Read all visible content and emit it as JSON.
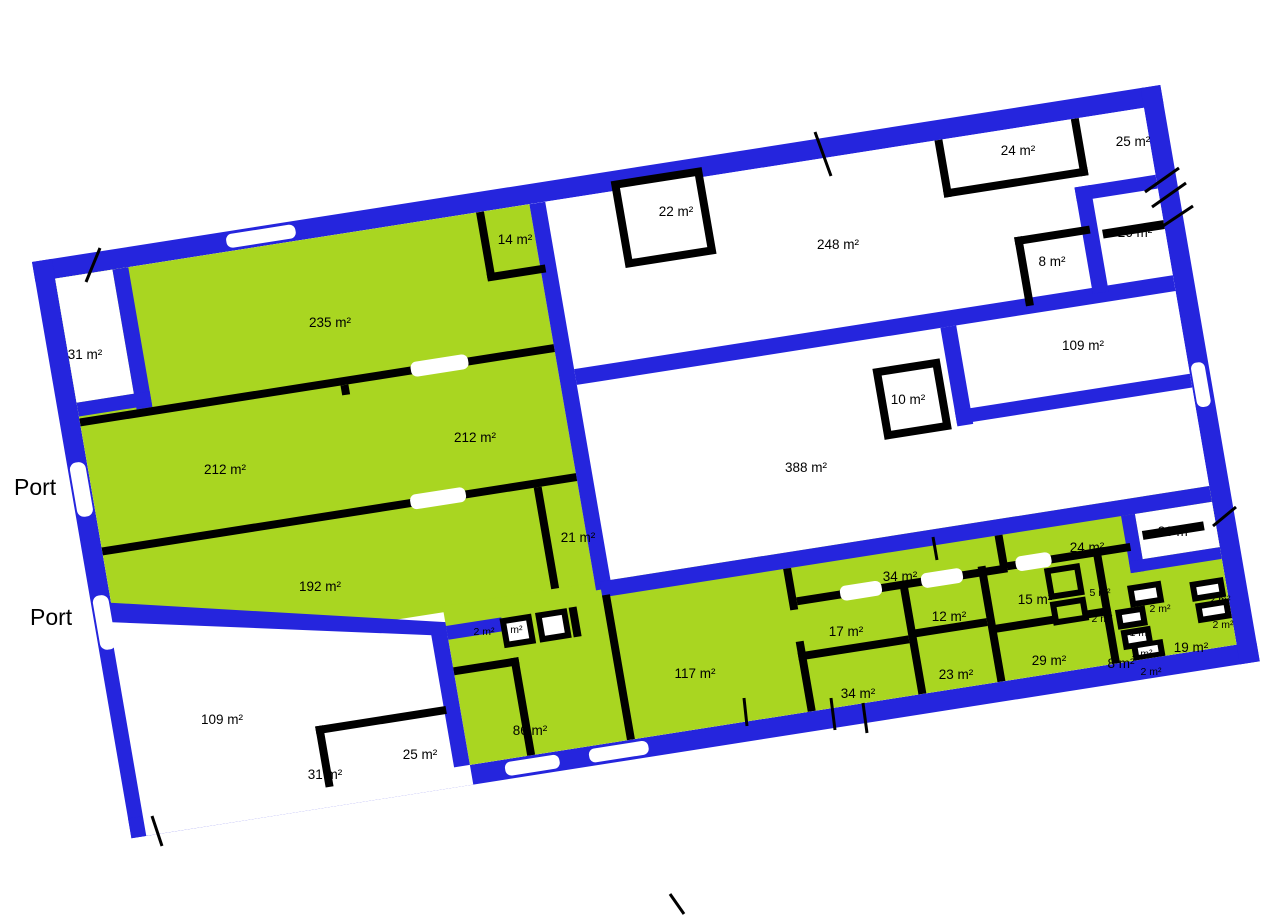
{
  "plan": {
    "colors": {
      "wall_exterior": "#2525dd",
      "wall_interior": "#000000",
      "room_highlight": "#a9d621",
      "room_plain": "#ffffff",
      "label_color": "#000000",
      "background": "#ffffff"
    },
    "ports": [
      {
        "label": "Port",
        "x": 14,
        "y": 495
      },
      {
        "label": "Port",
        "x": 30,
        "y": 625
      }
    ],
    "rooms": [
      {
        "id": "31-top-left",
        "label": "31 m²",
        "highlighted": false,
        "x": 85,
        "y": 359,
        "small": false
      },
      {
        "id": "235",
        "label": "235 m²",
        "highlighted": true,
        "x": 330,
        "y": 327,
        "small": false
      },
      {
        "id": "14",
        "label": "14 m²",
        "highlighted": true,
        "x": 515,
        "y": 244,
        "small": false
      },
      {
        "id": "212-right",
        "label": "212 m²",
        "highlighted": true,
        "x": 475,
        "y": 442,
        "small": false
      },
      {
        "id": "212-left",
        "label": "212 m²",
        "highlighted": true,
        "x": 225,
        "y": 474,
        "small": false
      },
      {
        "id": "192",
        "label": "192 m²",
        "highlighted": true,
        "x": 320,
        "y": 591,
        "small": false
      },
      {
        "id": "21",
        "label": "21 m²",
        "highlighted": true,
        "x": 578,
        "y": 542,
        "small": false
      },
      {
        "id": "2-box-a",
        "label": "2 m²",
        "highlighted": false,
        "x": 484,
        "y": 635,
        "small": true
      },
      {
        "id": "2-box-b",
        "label": "2 m²",
        "highlighted": false,
        "x": 512,
        "y": 633,
        "small": true
      },
      {
        "id": "22",
        "label": "22 m²",
        "highlighted": false,
        "x": 676,
        "y": 216,
        "small": false
      },
      {
        "id": "248",
        "label": "248 m²",
        "highlighted": false,
        "x": 838,
        "y": 249,
        "small": false
      },
      {
        "id": "24-top",
        "label": "24 m²",
        "highlighted": false,
        "x": 1018,
        "y": 155,
        "small": false
      },
      {
        "id": "25-top",
        "label": "25 m²",
        "highlighted": false,
        "x": 1133,
        "y": 146,
        "small": false
      },
      {
        "id": "26-upper",
        "label": "26 m²",
        "highlighted": false,
        "x": 1135,
        "y": 237,
        "small": false
      },
      {
        "id": "8-upper",
        "label": "8 m²",
        "highlighted": false,
        "x": 1052,
        "y": 266,
        "small": false
      },
      {
        "id": "109-right",
        "label": "109 m²",
        "highlighted": false,
        "x": 1083,
        "y": 350,
        "small": false
      },
      {
        "id": "10",
        "label": "10 m²",
        "highlighted": false,
        "x": 908,
        "y": 404,
        "small": false
      },
      {
        "id": "388",
        "label": "388 m²",
        "highlighted": false,
        "x": 806,
        "y": 472,
        "small": false
      },
      {
        "id": "26-lower",
        "label": "26 m²",
        "highlighted": false,
        "x": 1175,
        "y": 536,
        "small": false
      },
      {
        "id": "34-corridor",
        "label": "34 m²",
        "highlighted": true,
        "x": 900,
        "y": 581,
        "small": false
      },
      {
        "id": "24-corridor",
        "label": "24 m²",
        "highlighted": true,
        "x": 1087,
        "y": 552,
        "small": false
      },
      {
        "id": "15",
        "label": "15 m²",
        "highlighted": true,
        "x": 1035,
        "y": 604,
        "small": false
      },
      {
        "id": "5",
        "label": "5 m²",
        "highlighted": true,
        "x": 1100,
        "y": 596,
        "small": true
      },
      {
        "id": "2-green",
        "label": "2 m²",
        "highlighted": true,
        "x": 1102,
        "y": 622,
        "small": true
      },
      {
        "id": "2-white-mid",
        "label": "2 m²",
        "highlighted": false,
        "x": 1160,
        "y": 612,
        "small": true
      },
      {
        "id": "1-a",
        "label": "1 m²",
        "highlighted": false,
        "x": 1140,
        "y": 636,
        "small": true
      },
      {
        "id": "1-b",
        "label": "1 m²",
        "highlighted": false,
        "x": 1142,
        "y": 657,
        "small": true
      },
      {
        "id": "8-small",
        "label": "8 m²",
        "highlighted": true,
        "x": 1121,
        "y": 668,
        "small": false
      },
      {
        "id": "2-white-bottom",
        "label": "2 m²",
        "highlighted": false,
        "x": 1151,
        "y": 675,
        "small": true
      },
      {
        "id": "19",
        "label": "19 m²",
        "highlighted": true,
        "x": 1191,
        "y": 652,
        "small": false
      },
      {
        "id": "2-right-a",
        "label": "2 m²",
        "highlighted": false,
        "x": 1220,
        "y": 603,
        "small": true
      },
      {
        "id": "2-right-b",
        "label": "2 m²",
        "highlighted": false,
        "x": 1223,
        "y": 628,
        "small": true
      },
      {
        "id": "12",
        "label": "12 m²",
        "highlighted": true,
        "x": 949,
        "y": 621,
        "small": false
      },
      {
        "id": "23",
        "label": "23 m²",
        "highlighted": true,
        "x": 956,
        "y": 679,
        "small": false
      },
      {
        "id": "17",
        "label": "17 m²",
        "highlighted": true,
        "x": 846,
        "y": 636,
        "small": false
      },
      {
        "id": "34-lower",
        "label": "34 m²",
        "highlighted": true,
        "x": 858,
        "y": 698,
        "small": false
      },
      {
        "id": "29",
        "label": "29 m²",
        "highlighted": true,
        "x": 1049,
        "y": 665,
        "small": false
      },
      {
        "id": "117",
        "label": "117 m²",
        "highlighted": true,
        "x": 695,
        "y": 678,
        "small": false
      },
      {
        "id": "86",
        "label": "86 m²",
        "highlighted": true,
        "x": 530,
        "y": 735,
        "small": false
      },
      {
        "id": "25-green",
        "label": "25 m²",
        "highlighted": true,
        "x": 420,
        "y": 759,
        "small": false
      },
      {
        "id": "109-left",
        "label": "109 m²",
        "highlighted": false,
        "x": 222,
        "y": 724,
        "small": false
      },
      {
        "id": "31-nested",
        "label": "31 m²",
        "highlighted": false,
        "x": 325,
        "y": 779,
        "small": false
      }
    ]
  }
}
